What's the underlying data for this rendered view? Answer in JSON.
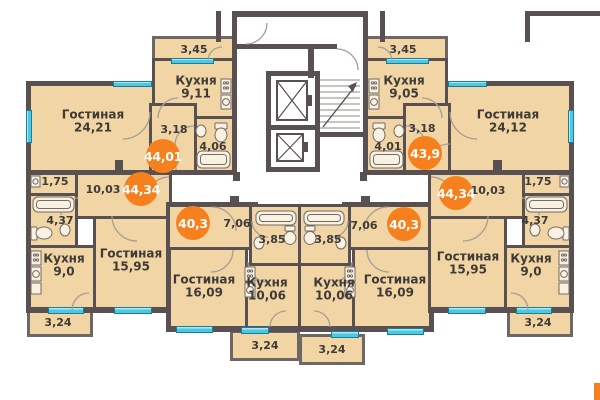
{
  "palette": {
    "wall": "#595052",
    "room_fill": "#f1d5a5",
    "window": "#4dc8e3",
    "badge": "#f6801e",
    "label_text": "#3e3a37"
  },
  "apartments": {
    "top_left": {
      "badge": "44,01",
      "living_name": "Гостиная",
      "living_area": "24,21",
      "kitchen_name": "Кухня",
      "kitchen_area": "9,11",
      "hall": "3,18",
      "bath": "4,06",
      "balcony": "3,45"
    },
    "mid_left": {
      "badge": "44,34",
      "living_name": "Гостиная",
      "living_area": "15,95",
      "kitchen_name": "Кухня",
      "kitchen_area": "9,0",
      "hall": "10,03",
      "closet": "1,75",
      "bath": "4,37",
      "balcony": "3,24"
    },
    "bottom_left": {
      "badge": "40,3",
      "living_name": "Гостиная",
      "living_area": "16,09",
      "kitchen_name": "Кухня",
      "kitchen_area": "10,06",
      "hall": "7,06",
      "bath": "3,85",
      "balcony": "3,24"
    },
    "top_right": {
      "badge": "43,9",
      "living_name": "Гостиная",
      "living_area": "24,12",
      "kitchen_name": "Кухня",
      "kitchen_area": "9,05",
      "hall": "3,18",
      "bath": "4,01",
      "balcony": "3,45"
    },
    "mid_right": {
      "badge": "44,34",
      "living_name": "Гостиная",
      "living_area": "15,95",
      "kitchen_name": "Кухня",
      "kitchen_area": "9,0",
      "hall": "10,03",
      "closet": "1,75",
      "bath": "4,37",
      "balcony": "3,24"
    },
    "bottom_right": {
      "badge": "40,3",
      "living_name": "Гостиная",
      "living_area": "16,09",
      "kitchen_name": "Кухня",
      "kitchen_area": "10,06",
      "hall": "7,06",
      "bath": "3,85",
      "balcony": "3,24"
    }
  }
}
